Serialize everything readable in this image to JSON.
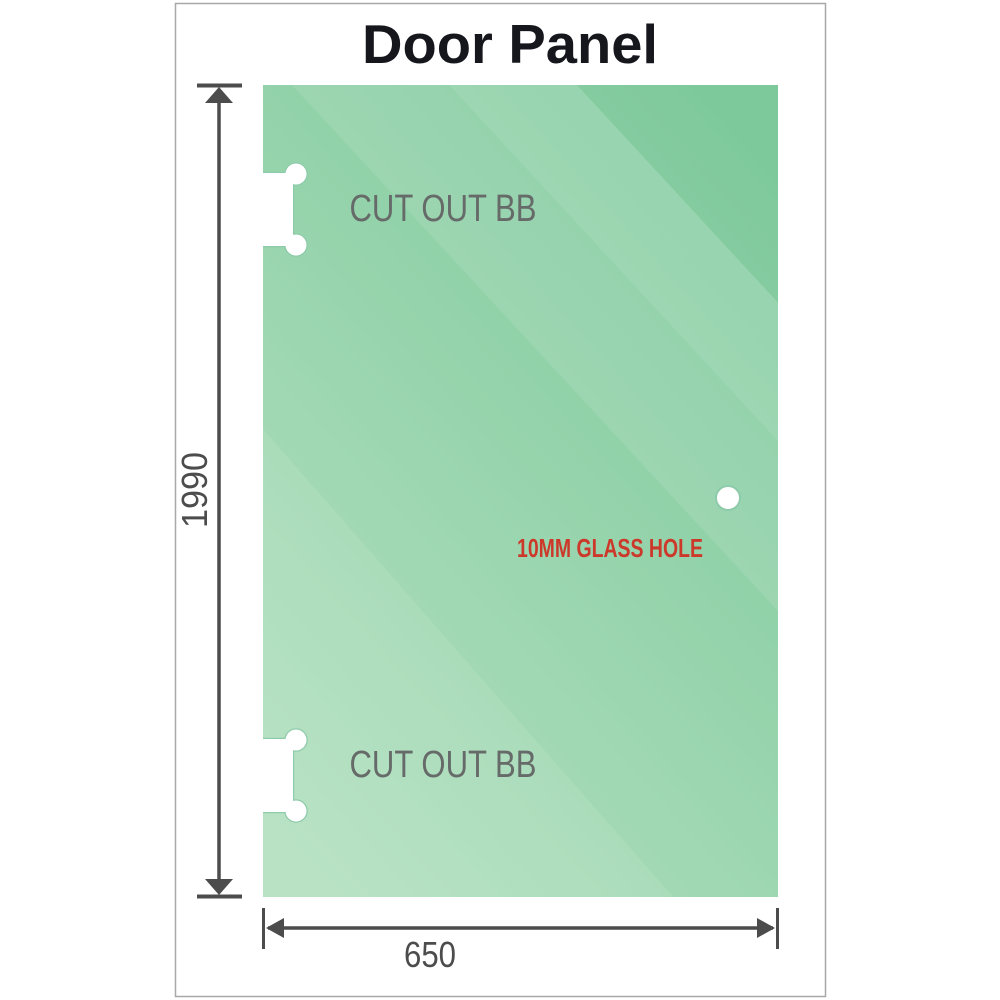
{
  "title": "Door Panel",
  "panel": {
    "cutouts": [
      {
        "label": "CUT OUT BB"
      },
      {
        "label": "CUT OUT BB"
      }
    ],
    "hole_label": "10MM GLASS HOLE"
  },
  "dimensions": {
    "height": "1990",
    "width": "650"
  },
  "colors": {
    "glass_dark": "#7ec99c",
    "glass_light": "#b2e0bf",
    "cutout_halo": "#8ecbaa",
    "label_gray": "#666b69",
    "label_red": "#cc392b",
    "dimension_gray": "#4c4c4c",
    "title_color": "#16161d",
    "frame_border": "#a8a8a8"
  }
}
